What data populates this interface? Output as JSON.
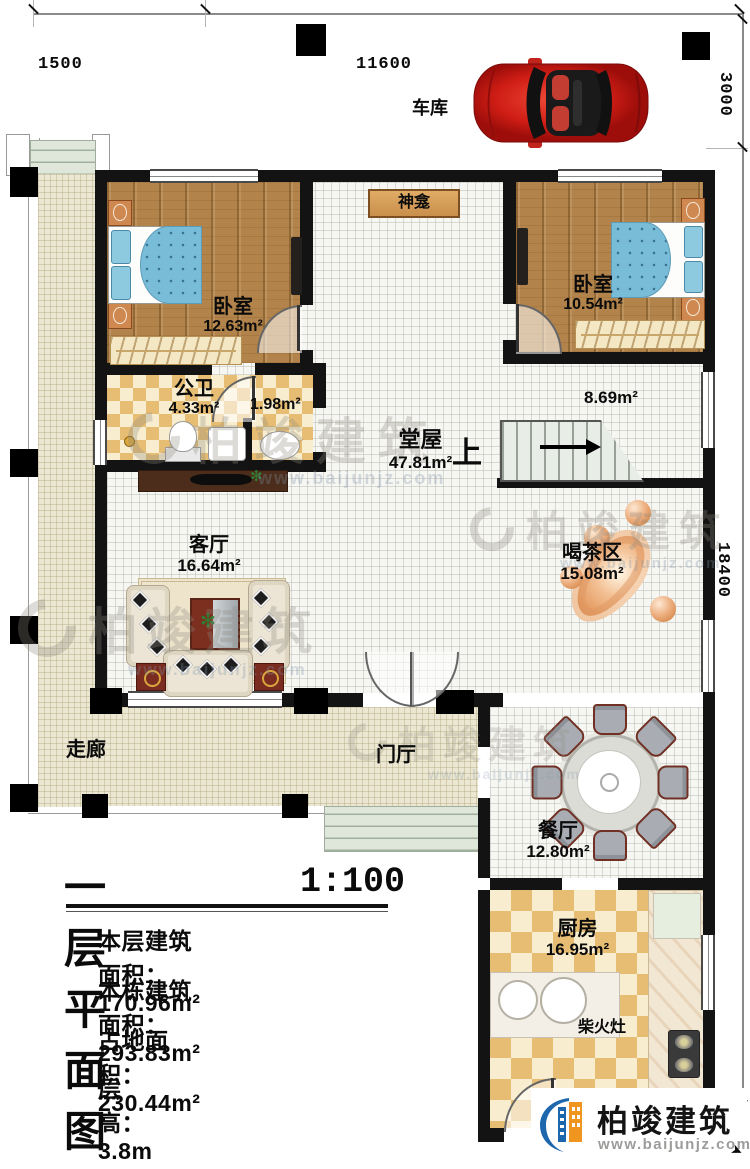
{
  "dims": {
    "left": "1500",
    "top": "11600",
    "right_top": "3000",
    "right_side": "18400"
  },
  "labels": {
    "garage": "车库",
    "shrine": "神龛",
    "bedroom_left_name": "卧室",
    "bedroom_left_area": "12.63m²",
    "bedroom_right_name": "卧室",
    "bedroom_right_area": "10.54m²",
    "bath_name": "公卫",
    "bath_area": "4.33m²",
    "vestibule_area": "1.98m²",
    "hall_name": "堂屋",
    "hall_area": "47.81m²",
    "stair_zone_area": "8.69m²",
    "stairs_up": "上",
    "living_name": "客厅",
    "living_area": "16.64m²",
    "tea_name": "喝茶区",
    "tea_area": "15.08m²",
    "corridor": "走廊",
    "foyer": "门厅",
    "dining_name": "餐厅",
    "dining_area": "12.80m²",
    "kitchen_name": "厨房",
    "kitchen_area": "16.95m²",
    "wood_stove": "柴火灶"
  },
  "title_block": {
    "title": "一层平面图",
    "scale": "1:100",
    "line1": "本层建筑面积：170.96m²",
    "line2": "本栋建筑面积：293.83m²",
    "line3": "占地面积：230.44m²",
    "line4": "层高：3.8m"
  },
  "branding": {
    "name": "柏竣建筑",
    "site": "www.baijunjz.com"
  },
  "watermark": {
    "name": "柏竣建筑",
    "site": "www.baijunjz.com"
  },
  "colors": {
    "wall": "#131313",
    "wood": "#b2834a",
    "accent_blue": "#1d67ad",
    "accent_orange": "#f0951f",
    "car_red": "#c01210"
  }
}
